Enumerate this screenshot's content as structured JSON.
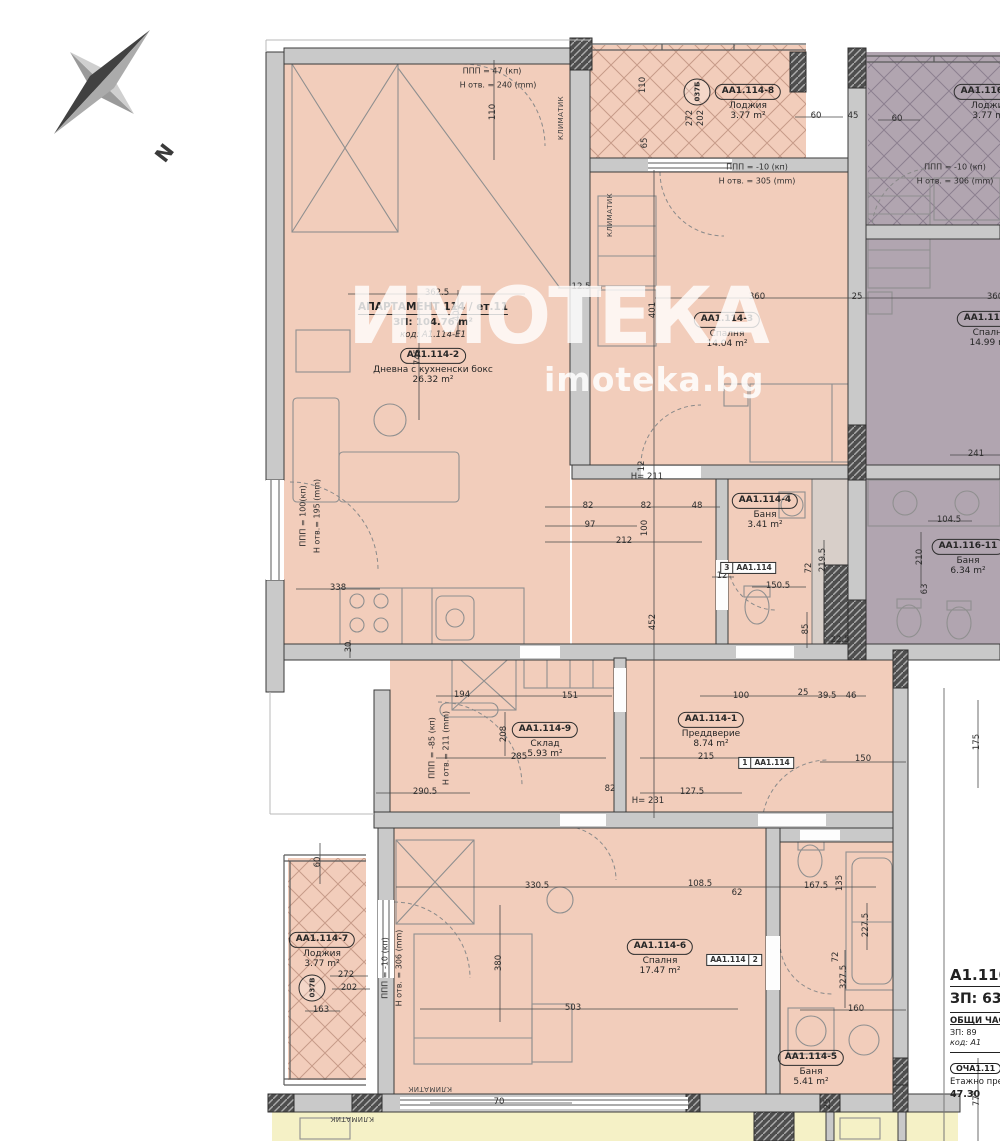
{
  "compass": {
    "label": "N"
  },
  "watermark": {
    "brand": "ИМОТЕКА",
    "site": "imoteka.bg"
  },
  "apartment": {
    "title": "АПАРТАМЕНТ 114 / ет.11",
    "area": "ЗП: 104.76 m²",
    "code": "код: A1.114-E1"
  },
  "rooms": [
    {
      "id": "AA1.114-2",
      "name": "Дневна с кухненски бокс",
      "area": "26.32 m²",
      "x": 433,
      "y": 364
    },
    {
      "id": "AA1.114-3",
      "name": "Спалня",
      "area": "14.04 m²",
      "x": 727,
      "y": 328
    },
    {
      "id": "AA1.114-8",
      "name": "Лоджия",
      "area": "3.77 m²",
      "x": 748,
      "y": 100
    },
    {
      "id": "AA1.116-10",
      "name": "Лоджия",
      "area": "3.77 m²",
      "x": 990,
      "y": 100
    },
    {
      "id": "AA1.116-9",
      "name": "Спалня",
      "area": "14.99 m²",
      "x": 990,
      "y": 327
    },
    {
      "id": "AA1.114-4",
      "name": "Баня",
      "area": "3.41 m²",
      "x": 765,
      "y": 509
    },
    {
      "id": "AA1.116-11",
      "name": "Баня",
      "area": "6.34 m²",
      "x": 968,
      "y": 555
    },
    {
      "id": "AA1.114-9",
      "name": "Склад",
      "area": "5.93 m²",
      "x": 545,
      "y": 738
    },
    {
      "id": "AA1.114-1",
      "name": "Преддверие",
      "area": "8.74 m²",
      "x": 711,
      "y": 728
    },
    {
      "id": "AA1.114-6",
      "name": "Спалня",
      "area": "17.47 m²",
      "x": 660,
      "y": 955
    },
    {
      "id": "AA1.114-7",
      "name": "Лоджия",
      "area": "3.77 m²",
      "x": 322,
      "y": 948
    },
    {
      "id": "AA1.114-5",
      "name": "Баня",
      "area": "5.41 m²",
      "x": 811,
      "y": 1066
    }
  ],
  "annotations": [
    {
      "text": "ППП = 47 (кп)",
      "x": 492,
      "y": 71
    },
    {
      "text": "Н отв. = 240 (mm)",
      "x": 498,
      "y": 85
    },
    {
      "text": "ППП = -10 (кп)",
      "x": 757,
      "y": 167
    },
    {
      "text": "Н отв. = 305 (mm)",
      "x": 757,
      "y": 181
    },
    {
      "text": "ППП = -10 (кп)",
      "x": 955,
      "y": 167
    },
    {
      "text": "Н отв. = 306 (mm)",
      "x": 955,
      "y": 181
    },
    {
      "text": "ППП = 100(кп)",
      "x": 303,
      "y": 516,
      "v": true
    },
    {
      "text": "Н отв.= 195 (mm)",
      "x": 317,
      "y": 516,
      "v": true
    },
    {
      "text": "ППП = -85 (кп)",
      "x": 432,
      "y": 748,
      "v": true
    },
    {
      "text": "Н отв.= 211 (mm)",
      "x": 446,
      "y": 748,
      "v": true
    },
    {
      "text": "ППП = -10 (кп)",
      "x": 385,
      "y": 968,
      "v": true
    },
    {
      "text": "Н отв. = 306 (mm)",
      "x": 399,
      "y": 968,
      "v": true
    },
    {
      "text": "КЛИМАТИК",
      "x": 561,
      "y": 118,
      "v": true,
      "small": true
    },
    {
      "text": "КЛИМАТИК",
      "x": 610,
      "y": 215,
      "v": true,
      "small": true
    },
    {
      "text": "КЛИМАТИК",
      "x": 430,
      "y": 1089,
      "flip": true,
      "small": true
    },
    {
      "text": "КЛИМАТИК",
      "x": 352,
      "y": 1119,
      "flip": true,
      "small": true
    }
  ],
  "tags": [
    {
      "a": "3",
      "b": "AA1.114",
      "x": 748,
      "y": 568
    },
    {
      "a": "1",
      "b": "AA1.114",
      "x": 766,
      "y": 763
    },
    {
      "a": "AA1.114",
      "b": "2",
      "x": 734,
      "y": 960
    }
  ],
  "risers": [
    {
      "text": "037Б",
      "x": 697,
      "y": 92
    },
    {
      "text": "037В",
      "x": 312,
      "y": 988
    }
  ],
  "dims": [
    {
      "t": "362.5",
      "x": 437,
      "y": 294
    },
    {
      "t": "12.5",
      "x": 581,
      "y": 288
    },
    {
      "t": "360",
      "x": 757,
      "y": 298
    },
    {
      "t": "25",
      "x": 857,
      "y": 298
    },
    {
      "t": "360",
      "x": 995,
      "y": 298
    },
    {
      "t": "110",
      "x": 494,
      "y": 112,
      "v": true
    },
    {
      "t": "110",
      "x": 644,
      "y": 85,
      "v": true
    },
    {
      "t": "65",
      "x": 646,
      "y": 143,
      "v": true
    },
    {
      "t": "272",
      "x": 691,
      "y": 118,
      "v": true
    },
    {
      "t": "202",
      "x": 702,
      "y": 118,
      "v": true
    },
    {
      "t": "60",
      "x": 816,
      "y": 117
    },
    {
      "t": "45",
      "x": 853,
      "y": 117
    },
    {
      "t": "60",
      "x": 897,
      "y": 120
    },
    {
      "t": "403",
      "x": 458,
      "y": 313,
      "v": true
    },
    {
      "t": "745",
      "x": 419,
      "y": 357,
      "v": true
    },
    {
      "t": "401",
      "x": 654,
      "y": 310,
      "v": true
    },
    {
      "t": "241",
      "x": 976,
      "y": 455
    },
    {
      "t": "104.5",
      "x": 949,
      "y": 521
    },
    {
      "t": "210",
      "x": 921,
      "y": 557,
      "v": true
    },
    {
      "t": "63",
      "x": 926,
      "y": 589,
      "v": true
    },
    {
      "t": "338",
      "x": 338,
      "y": 589
    },
    {
      "t": "30",
      "x": 350,
      "y": 647,
      "v": true
    },
    {
      "t": "82",
      "x": 588,
      "y": 507
    },
    {
      "t": "82",
      "x": 646,
      "y": 507
    },
    {
      "t": "48",
      "x": 697,
      "y": 507
    },
    {
      "t": "97",
      "x": 590,
      "y": 526
    },
    {
      "t": "212",
      "x": 624,
      "y": 542
    },
    {
      "t": "H= 211",
      "x": 647,
      "y": 478
    },
    {
      "t": "12",
      "x": 643,
      "y": 466,
      "v": true
    },
    {
      "t": "100",
      "x": 646,
      "y": 528,
      "v": true
    },
    {
      "t": "452",
      "x": 654,
      "y": 622,
      "v": true
    },
    {
      "t": "12",
      "x": 722,
      "y": 577
    },
    {
      "t": "150.5",
      "x": 778,
      "y": 587
    },
    {
      "t": "219.5",
      "x": 824,
      "y": 560,
      "v": true
    },
    {
      "t": "72",
      "x": 810,
      "y": 568,
      "v": true
    },
    {
      "t": "85",
      "x": 807,
      "y": 629,
      "v": true
    },
    {
      "t": "22.5",
      "x": 840,
      "y": 641
    },
    {
      "t": "194",
      "x": 462,
      "y": 696
    },
    {
      "t": "151",
      "x": 570,
      "y": 697
    },
    {
      "t": "285",
      "x": 519,
      "y": 758
    },
    {
      "t": "208",
      "x": 505,
      "y": 734,
      "v": true
    },
    {
      "t": "290.5",
      "x": 425,
      "y": 793
    },
    {
      "t": "215",
      "x": 706,
      "y": 758
    },
    {
      "t": "127.5",
      "x": 692,
      "y": 793
    },
    {
      "t": "82",
      "x": 610,
      "y": 790
    },
    {
      "t": "H= 231",
      "x": 648,
      "y": 802
    },
    {
      "t": "100",
      "x": 741,
      "y": 697
    },
    {
      "t": "25",
      "x": 803,
      "y": 694
    },
    {
      "t": "39.5",
      "x": 827,
      "y": 697
    },
    {
      "t": "46",
      "x": 851,
      "y": 697
    },
    {
      "t": "150",
      "x": 863,
      "y": 760
    },
    {
      "t": "175",
      "x": 978,
      "y": 742,
      "v": true
    },
    {
      "t": "330.5",
      "x": 537,
      "y": 887
    },
    {
      "t": "108.5",
      "x": 700,
      "y": 885
    },
    {
      "t": "62",
      "x": 737,
      "y": 894
    },
    {
      "t": "167.5",
      "x": 816,
      "y": 887
    },
    {
      "t": "135",
      "x": 841,
      "y": 883,
      "v": true
    },
    {
      "t": "227.5",
      "x": 867,
      "y": 925,
      "v": true
    },
    {
      "t": "72",
      "x": 837,
      "y": 957,
      "v": true
    },
    {
      "t": "327.5",
      "x": 845,
      "y": 977,
      "v": true
    },
    {
      "t": "380",
      "x": 500,
      "y": 963,
      "v": true
    },
    {
      "t": "503",
      "x": 573,
      "y": 1009
    },
    {
      "t": "160",
      "x": 856,
      "y": 1010
    },
    {
      "t": "70",
      "x": 499,
      "y": 1103
    },
    {
      "t": "25",
      "x": 829,
      "y": 1104,
      "v": true
    },
    {
      "t": "775",
      "x": 978,
      "y": 1098,
      "v": true
    },
    {
      "t": "60",
      "x": 319,
      "y": 862,
      "v": true
    },
    {
      "t": "272",
      "x": 346,
      "y": 976
    },
    {
      "t": "202",
      "x": 349,
      "y": 989
    },
    {
      "t": "163",
      "x": 321,
      "y": 1011
    }
  ],
  "info": {
    "line1": "A1.110 -",
    "line2": "ЗП: 63",
    "line3": "ОБЩИ ЧАСТИ",
    "line4": "ЗП: 89",
    "line5": "код: А1",
    "tag": "ОЧА1.11",
    "line6": "Етажно пре",
    "line7": "47.30"
  }
}
